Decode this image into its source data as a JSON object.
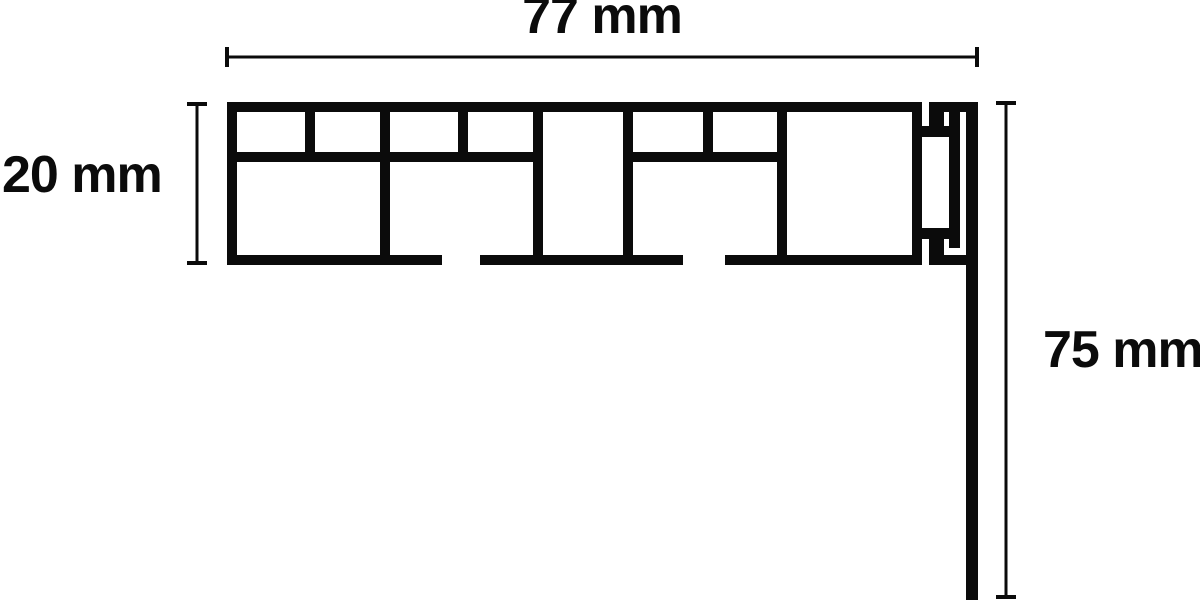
{
  "diagram": {
    "title": "Curtain rail profile cross-section with dimensions",
    "background": "#ffffff",
    "ink": "#0b0b0b",
    "dimensions": [
      {
        "id": "width",
        "label": "77 mm",
        "value": 77,
        "unit": "mm",
        "orientation": "horizontal"
      },
      {
        "id": "height",
        "label": "20 mm",
        "value": 20,
        "unit": "mm",
        "orientation": "vertical"
      },
      {
        "id": "drop",
        "label": "75 mm",
        "value": 75,
        "unit": "mm",
        "orientation": "vertical"
      }
    ],
    "geometry": {
      "dimension_line_thickness": 3,
      "dimension_cap_length": 20,
      "dimension_cap_thickness": 4,
      "dimension_lines": [
        {
          "name": "dim-line-width-77mm",
          "orientation": "horizontal",
          "x1": 227,
          "y1": 57,
          "x2": 977,
          "y2": 57
        },
        {
          "name": "dim-line-height-20mm",
          "orientation": "vertical",
          "x1": 197,
          "y1": 104,
          "x2": 197,
          "y2": 263
        },
        {
          "name": "dim-line-drop-75mm",
          "orientation": "vertical",
          "x1": 1006,
          "y1": 103,
          "x2": 1006,
          "y2": 597
        }
      ],
      "profile_rects": [
        {
          "name": "top-wall",
          "x": 227,
          "y": 102,
          "w": 695,
          "h": 10
        },
        {
          "name": "left-wall",
          "x": 227,
          "y": 102,
          "w": 10,
          "h": 163
        },
        {
          "name": "bottom-wall-left",
          "x": 227,
          "y": 255,
          "w": 215,
          "h": 10
        },
        {
          "name": "bottom-wall-middle",
          "x": 480,
          "y": 255,
          "w": 203,
          "h": 10
        },
        {
          "name": "bottom-wall-right",
          "x": 725,
          "y": 255,
          "w": 197,
          "h": 10
        },
        {
          "name": "right-wall",
          "x": 912,
          "y": 102,
          "w": 10,
          "h": 163
        },
        {
          "name": "mid-shelf-left",
          "x": 227,
          "y": 152,
          "w": 316,
          "h": 10
        },
        {
          "name": "mid-shelf-right",
          "x": 633,
          "y": 152,
          "w": 154,
          "h": 10
        },
        {
          "name": "web-full-1",
          "x": 380,
          "y": 112,
          "w": 10,
          "h": 143
        },
        {
          "name": "web-full-2",
          "x": 533,
          "y": 112,
          "w": 10,
          "h": 143
        },
        {
          "name": "web-full-3",
          "x": 623,
          "y": 112,
          "w": 10,
          "h": 143
        },
        {
          "name": "web-full-4",
          "x": 777,
          "y": 112,
          "w": 10,
          "h": 143
        },
        {
          "name": "web-top-1",
          "x": 305,
          "y": 112,
          "w": 10,
          "h": 50
        },
        {
          "name": "web-top-2",
          "x": 458,
          "y": 112,
          "w": 10,
          "h": 50
        },
        {
          "name": "web-top-3",
          "x": 703,
          "y": 112,
          "w": 10,
          "h": 50
        },
        {
          "name": "clip-top-bar",
          "x": 929,
          "y": 102,
          "w": 49,
          "h": 10
        },
        {
          "name": "clip-bottom-bar",
          "x": 929,
          "y": 255,
          "w": 49,
          "h": 10
        },
        {
          "name": "drop-leg",
          "x": 966,
          "y": 102,
          "w": 12,
          "h": 498
        },
        {
          "name": "clip-inner-vertical",
          "x": 949,
          "y": 112,
          "w": 11,
          "h": 136
        },
        {
          "name": "clip-top-finger",
          "x": 929,
          "y": 112,
          "w": 15,
          "h": 14
        },
        {
          "name": "clip-top-bridge",
          "x": 912,
          "y": 126,
          "w": 37,
          "h": 11
        },
        {
          "name": "clip-bottom-finger",
          "x": 929,
          "y": 239,
          "w": 15,
          "h": 16
        },
        {
          "name": "clip-bottom-bridge",
          "x": 912,
          "y": 228,
          "w": 37,
          "h": 11
        }
      ]
    }
  }
}
